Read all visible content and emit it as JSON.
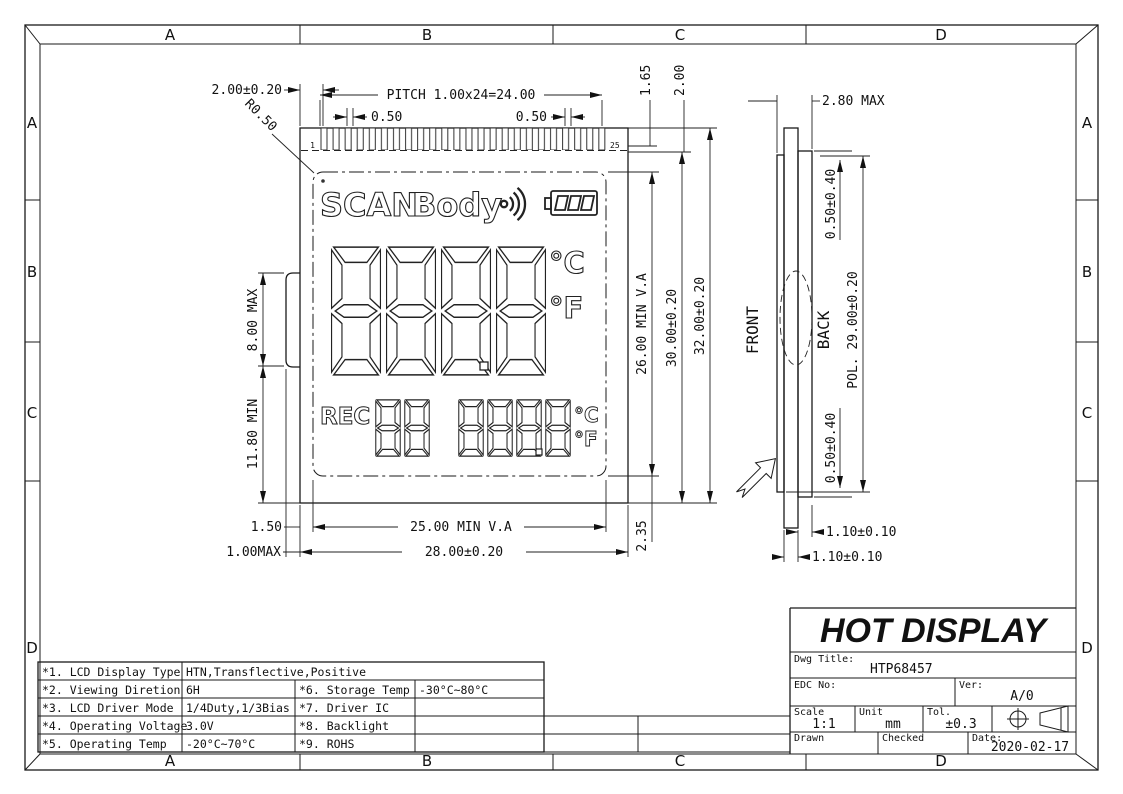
{
  "colors": {
    "line": "#1a1a1a",
    "background": "#ffffff"
  },
  "zones": {
    "top": [
      "A",
      "B",
      "C",
      "D"
    ],
    "bottom": [
      "A",
      "B",
      "C",
      "D"
    ],
    "left": [
      "A",
      "B",
      "C",
      "D"
    ],
    "right": [
      "A",
      "B",
      "C",
      "D"
    ]
  },
  "front_view": {
    "pins": {
      "first": "1",
      "last": "25"
    },
    "display": {
      "scan": "SCAN",
      "body": "Body",
      "deg_c": "°C",
      "deg_f": "°F",
      "rec": "REC",
      "main_digits": "8888",
      "sub_digits_left": "88",
      "sub_digits_right": "888.8",
      "sub_deg_c": "°C",
      "sub_deg_f": "°F"
    },
    "dims": {
      "lead": "2.00±0.20",
      "pitch": "PITCH 1.00x24=24.00",
      "pin_w_l": "0.50",
      "pin_w_r": "0.50",
      "radius": "R0.50",
      "m165": "1.65",
      "m200": "2.00",
      "va_h": "26.00 MIN V.A",
      "h30": "30.00±0.20",
      "h32": "32.00±0.20",
      "m235": "2.35",
      "bump_h": "8.00 MAX",
      "lower_h": "11.80 MIN",
      "m150": "1.50",
      "m100": "1.00MAX",
      "va_w": "25.00 MIN V.A",
      "w28": "28.00±0.20"
    }
  },
  "side_view": {
    "front_label": "FRONT",
    "back_label": "BACK",
    "dims": {
      "thickness": "2.80 MAX",
      "pol_top": "0.50±0.40",
      "pol": "POL. 29.00±0.20",
      "pol_bottom": "0.50±0.40",
      "glass_upper": "1.10±0.10",
      "glass_lower": "1.10±0.10"
    }
  },
  "title_block": {
    "company": "HOT DISPLAY",
    "dwg_label": "Dwg Title:",
    "dwg_title": "HTP68457",
    "edc_label": "EDC No:",
    "ver_label": "Ver:",
    "ver": "A/0",
    "scale_label": "Scale",
    "scale": "1:1",
    "unit_label": "Unit",
    "unit": "mm",
    "tol_label": "Tol.",
    "tol": "±0.3",
    "drawn_label": "Drawn",
    "checked_label": "Checked",
    "date_label": "Date:",
    "date": "2020-02-17"
  },
  "spec_table": {
    "rows": [
      {
        "c1": "*1. LCD Display Type",
        "c2": "HTN,Transflective,Positive",
        "c3": "",
        "c4": ""
      },
      {
        "c1": "*2. Viewing Diretion",
        "c2": "6H",
        "c3": "*6. Storage Temp",
        "c4": "-30°C~80°C"
      },
      {
        "c1": "*3. LCD Driver Mode",
        "c2": "1/4Duty,1/3Bias",
        "c3": "*7. Driver IC",
        "c4": ""
      },
      {
        "c1": "*4. Operating Voltage",
        "c2": "3.0V",
        "c3": "*8. Backlight",
        "c4": ""
      },
      {
        "c1": "*5. Operating Temp",
        "c2": "-20°C~70°C",
        "c3": "*9. ROHS",
        "c4": ""
      }
    ]
  }
}
